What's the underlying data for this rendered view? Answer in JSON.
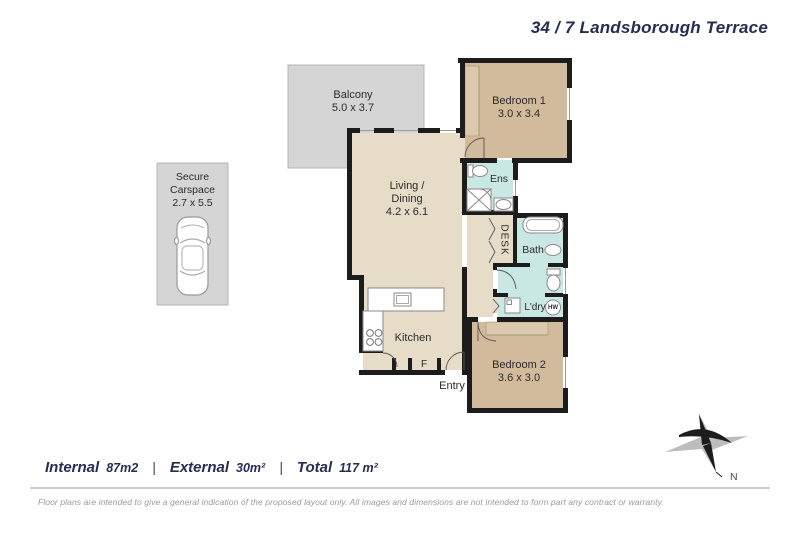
{
  "header": {
    "title": "34 / 7 Landsborough Terrace"
  },
  "rooms": {
    "balcony": {
      "name": "Balcony",
      "dims": "5.0 x 3.7"
    },
    "carspace": {
      "line1": "Secure",
      "line2": "Carspace",
      "dims": "2.7 x 5.5"
    },
    "bedroom1": {
      "name": "Bedroom 1",
      "dims": "3.0 x 3.4"
    },
    "living": {
      "line1": "Living /",
      "line2": "Dining",
      "dims": "4.2 x 6.1"
    },
    "ens": {
      "name": "Ens"
    },
    "desk": {
      "name": "DESK"
    },
    "bath": {
      "name": "Bath"
    },
    "ldry": {
      "name": "L'dry"
    },
    "hw": {
      "name": "HW"
    },
    "kitchen": {
      "name": "Kitchen"
    },
    "fridge": {
      "name": "F"
    },
    "entry": {
      "name": "Entry"
    },
    "bedroom2": {
      "name": "Bedroom 2",
      "dims": "3.6 x 3.0"
    }
  },
  "areas": {
    "internal_label": "Internal",
    "internal_value": "87m2",
    "external_label": "External",
    "external_value": "30m²",
    "total_label": "Total",
    "total_value": "117 m²",
    "separator": "|"
  },
  "compass": {
    "north_label": "N"
  },
  "disclaimer": "Floor plans are intended to give a general indication of the proposed layout only. All images and dimensions are not intended to form part any contract or warranty.",
  "colors": {
    "wall": "#1c1c1c",
    "floor_living": "#e6dcc8",
    "floor_bedroom": "#d2ba9c",
    "floor_wet": "#c9e7e3",
    "floor_outdoor": "#d5d5d5",
    "title_navy": "#252e52",
    "disclaimer_gray": "#9a9a9a"
  }
}
